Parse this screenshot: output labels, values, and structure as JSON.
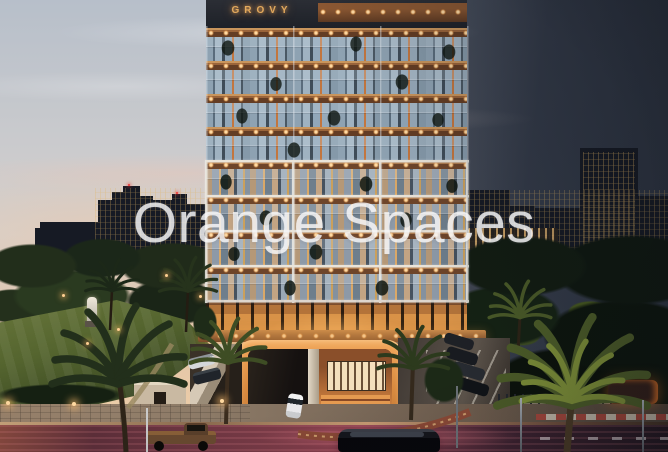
{
  "photo": {
    "alt": "Dusk architectural rendering of the GROVY residential tower with warm-lit balconies, landscaped garden, palm trees, parking entrance arch and street in the foreground, city skyline silhouettes on both sides",
    "watermark_text": "Orange Spaces",
    "building_sign_text": "GROVY",
    "colors": {
      "sky_top": "#b7bfca",
      "sky_mid": "#d6d0cc",
      "sky_horizon": "#eccda8",
      "sky_right_dark": "#343b49",
      "skyline_dark": "#161a24",
      "sign_gold": "#e2a95d",
      "watermark_white": "#f7f7f8",
      "balcony_light": "#ffd9a2",
      "slab_wood": "#9a643a",
      "glass_blue": "#92a7b9",
      "frame_white": "#eceae4",
      "arch_glow": "#f2a85c",
      "court_amber": "#cd7f3e",
      "lawn_green": "#55652f",
      "tree_dark": "#1b2719",
      "street_magenta": "#8e4150",
      "sidewalk_tan": "#8d7b68"
    }
  }
}
